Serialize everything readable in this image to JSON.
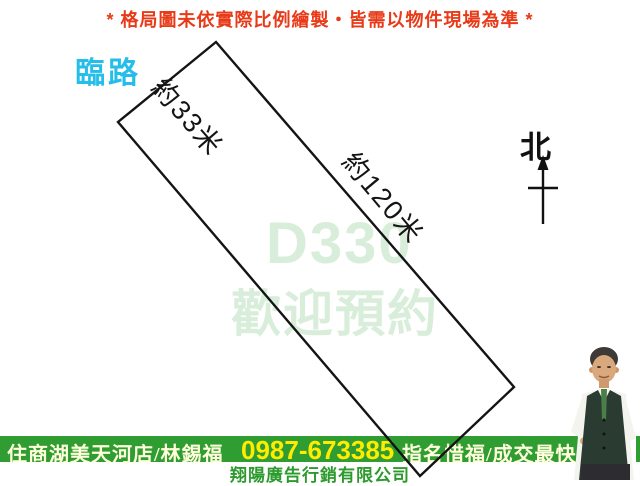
{
  "notice": {
    "text": "* 格局圖未依實際比例繪製‧皆需以物件現場為準 *"
  },
  "road": {
    "label": "臨路"
  },
  "plot": {
    "short_edge_label": "約33米",
    "long_edge_label": "約120米"
  },
  "watermark": {
    "code": "D330",
    "message": "歡迎預約"
  },
  "compass": {
    "label": "北"
  },
  "footer_bar": {
    "office_agent": "住商湖美天河店/林錫福",
    "phone": "0987-673385",
    "slogan": "指名惜福/成交最快",
    "company": "翔陽廣告行銷有限公司"
  },
  "colors": {
    "notice_red": "#e83a18",
    "road_cyan": "#25bde9",
    "watermark_green": "#d9eeda",
    "bar_green": "#2f9d31",
    "phone_yellow": "#ffec00",
    "bar_text_cream": "#ffffdc",
    "company_green": "#2d9a2d",
    "outline_black": "#141414"
  }
}
